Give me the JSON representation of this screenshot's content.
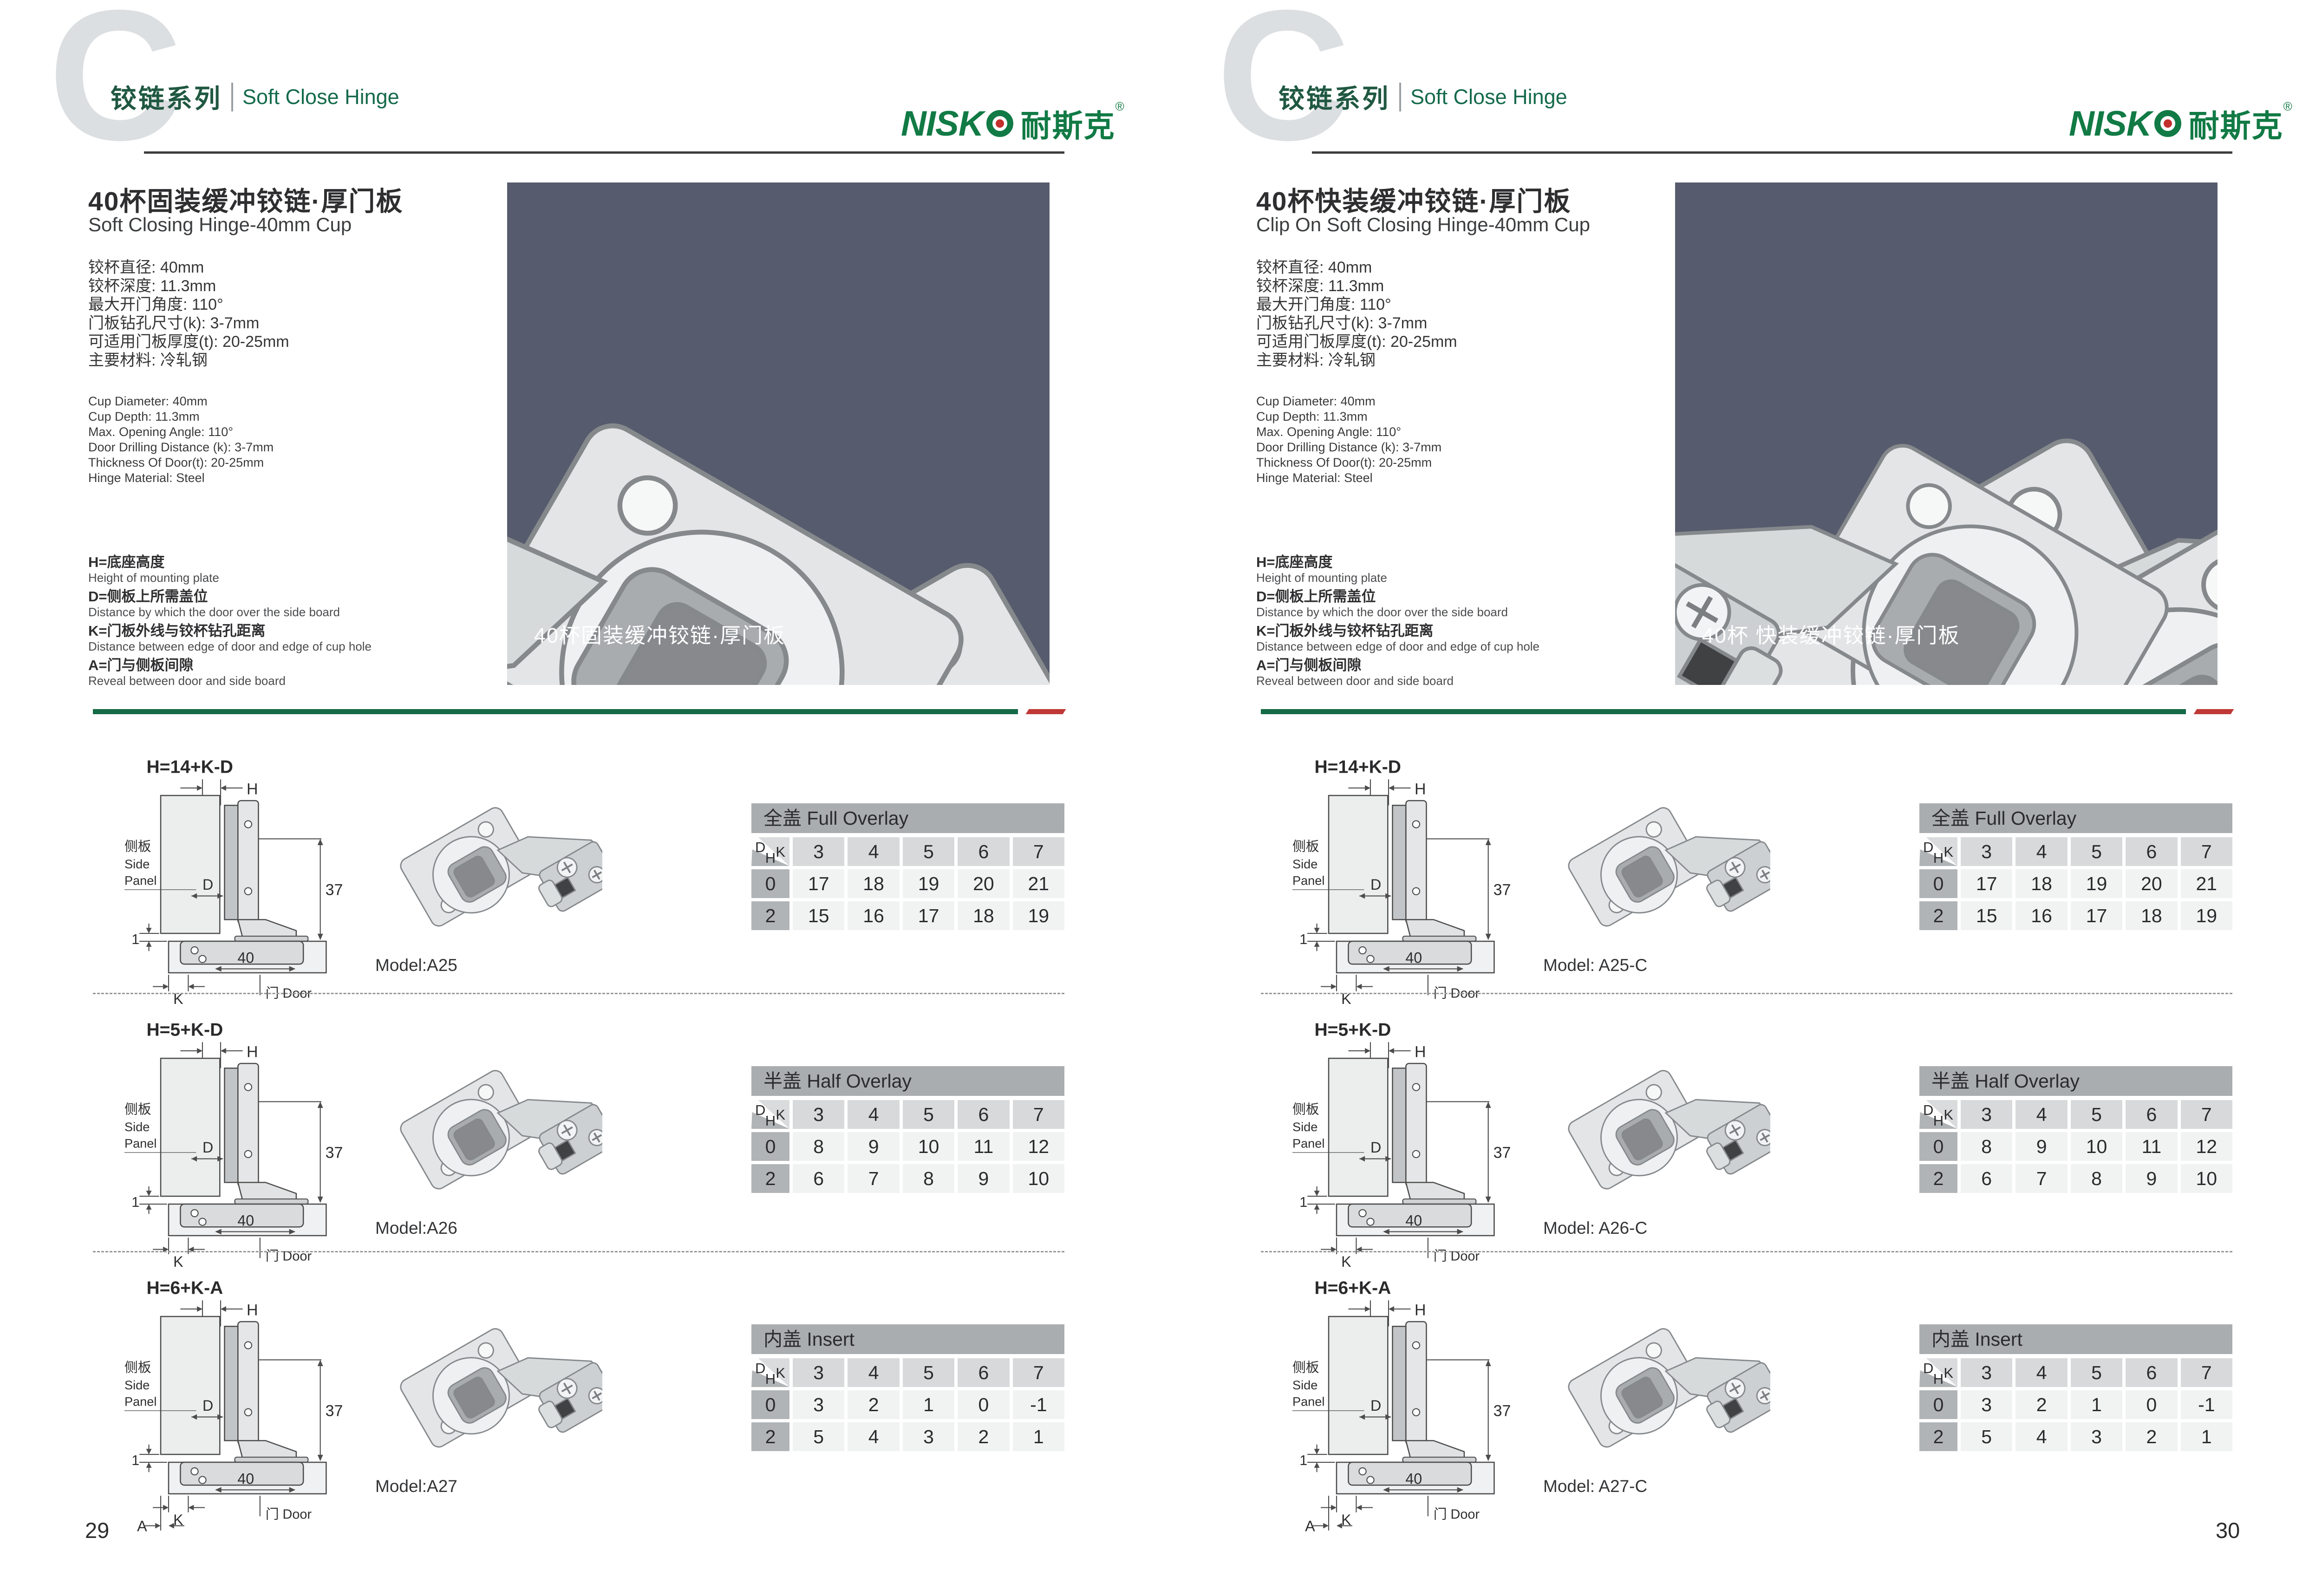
{
  "header": {
    "watermark": "C",
    "series_cn": "铰链系列",
    "series_en": "Soft Close Hinge",
    "brand_latin": "NISK",
    "brand_cn": "耐斯克",
    "brand_reg": "®"
  },
  "corner": {
    "d": "D",
    "k": "K",
    "h": "H"
  },
  "diagram_labels": {
    "H": "H",
    "D": "D",
    "K": "K",
    "A": "A",
    "dim37": "37",
    "dim40": "40",
    "dim1": "1",
    "side_cn": "侧板",
    "side_en1": "Side",
    "side_en2": "Panel",
    "door": "门 Door"
  },
  "pages": [
    {
      "page_number": "29",
      "title_cn": "40杯固装缓冲铰链·厚门板",
      "title_en": "Soft Closing Hinge-40mm Cup",
      "specs_cn": [
        "铰杯直径: 40mm",
        "铰杯深度: 11.3mm",
        "最大开门角度: 110°",
        "门板钻孔尺寸(k): 3-7mm",
        "可适用门板厚度(t): 20-25mm",
        "主要材料: 冷轧钢"
      ],
      "specs_en": [
        "Cup Diameter: 40mm",
        "Cup Depth: 11.3mm",
        "Max. Opening Angle: 110°",
        "Door Drilling Distance (k): 3-7mm",
        "Thickness Of Door(t): 20-25mm",
        "Hinge Material: Steel"
      ],
      "definitions": [
        {
          "cn": "H=底座高度",
          "en": "Height of mounting plate"
        },
        {
          "cn": "D=侧板上所需盖位",
          "en": "Distance by which the door over the side board"
        },
        {
          "cn": "K=门板外线与铰杯钻孔距离",
          "en": "Distance between edge of door and edge of cup hole"
        },
        {
          "cn": "A=门与侧板间隙",
          "en": "Reveal between door and side board"
        }
      ],
      "photo_caption": "40杯固装缓冲铰链·厚门板",
      "sections": [
        {
          "formula": "H=14+K-D",
          "model": "Model:A25",
          "table": {
            "title": "全盖 Full Overlay",
            "k": [
              "3",
              "4",
              "5",
              "6",
              "7"
            ],
            "rows": [
              {
                "h": "0",
                "v": [
                  "17",
                  "18",
                  "19",
                  "20",
                  "21"
                ]
              },
              {
                "h": "2",
                "v": [
                  "15",
                  "16",
                  "17",
                  "18",
                  "19"
                ]
              }
            ]
          }
        },
        {
          "formula": "H=5+K-D",
          "model": "Model:A26",
          "table": {
            "title": "半盖 Half Overlay",
            "k": [
              "3",
              "4",
              "5",
              "6",
              "7"
            ],
            "rows": [
              {
                "h": "0",
                "v": [
                  "8",
                  "9",
                  "10",
                  "11",
                  "12"
                ]
              },
              {
                "h": "2",
                "v": [
                  "6",
                  "7",
                  "8",
                  "9",
                  "10"
                ]
              }
            ]
          }
        },
        {
          "formula": "H=6+K-A",
          "model": "Model:A27",
          "table": {
            "title": "内盖 Insert",
            "k": [
              "3",
              "4",
              "5",
              "6",
              "7"
            ],
            "rows": [
              {
                "h": "0",
                "v": [
                  "3",
                  "2",
                  "1",
                  "0",
                  "-1"
                ]
              },
              {
                "h": "2",
                "v": [
                  "5",
                  "4",
                  "3",
                  "2",
                  "1"
                ]
              }
            ]
          }
        }
      ]
    },
    {
      "page_number": "30",
      "title_cn": "40杯快装缓冲铰链·厚门板",
      "title_en": "Clip On Soft Closing Hinge-40mm Cup",
      "specs_cn": [
        "铰杯直径: 40mm",
        "铰杯深度: 11.3mm",
        "最大开门角度: 110°",
        "门板钻孔尺寸(k): 3-7mm",
        "可适用门板厚度(t): 20-25mm",
        "主要材料: 冷轧钢"
      ],
      "specs_en": [
        "Cup Diameter: 40mm",
        "Cup Depth: 11.3mm",
        "Max. Opening Angle: 110°",
        "Door Drilling Distance (k): 3-7mm",
        "Thickness Of Door(t): 20-25mm",
        "Hinge Material: Steel"
      ],
      "definitions": [
        {
          "cn": "H=底座高度",
          "en": "Height of mounting plate"
        },
        {
          "cn": "D=侧板上所需盖位",
          "en": "Distance by which the door over the side board"
        },
        {
          "cn": "K=门板外线与铰杯钻孔距离",
          "en": "Distance between edge of door and edge of cup hole"
        },
        {
          "cn": "A=门与侧板间隙",
          "en": "Reveal between door and side board"
        }
      ],
      "photo_caption": "40杯 快装缓冲铰链·厚门板",
      "sections": [
        {
          "formula": "H=14+K-D",
          "model": "Model: A25-C",
          "table": {
            "title": "全盖 Full Overlay",
            "k": [
              "3",
              "4",
              "5",
              "6",
              "7"
            ],
            "rows": [
              {
                "h": "0",
                "v": [
                  "17",
                  "18",
                  "19",
                  "20",
                  "21"
                ]
              },
              {
                "h": "2",
                "v": [
                  "15",
                  "16",
                  "17",
                  "18",
                  "19"
                ]
              }
            ]
          }
        },
        {
          "formula": "H=5+K-D",
          "model": "Model: A26-C",
          "table": {
            "title": "半盖 Half Overlay",
            "k": [
              "3",
              "4",
              "5",
              "6",
              "7"
            ],
            "rows": [
              {
                "h": "0",
                "v": [
                  "8",
                  "9",
                  "10",
                  "11",
                  "12"
                ]
              },
              {
                "h": "2",
                "v": [
                  "6",
                  "7",
                  "8",
                  "9",
                  "10"
                ]
              }
            ]
          }
        },
        {
          "formula": "H=6+K-A",
          "model": "Model: A27-C",
          "table": {
            "title": "内盖 Insert",
            "k": [
              "3",
              "4",
              "5",
              "6",
              "7"
            ],
            "rows": [
              {
                "h": "0",
                "v": [
                  "3",
                  "2",
                  "1",
                  "0",
                  "-1"
                ]
              },
              {
                "h": "2",
                "v": [
                  "5",
                  "4",
                  "3",
                  "2",
                  "1"
                ]
              }
            ]
          }
        }
      ]
    }
  ]
}
